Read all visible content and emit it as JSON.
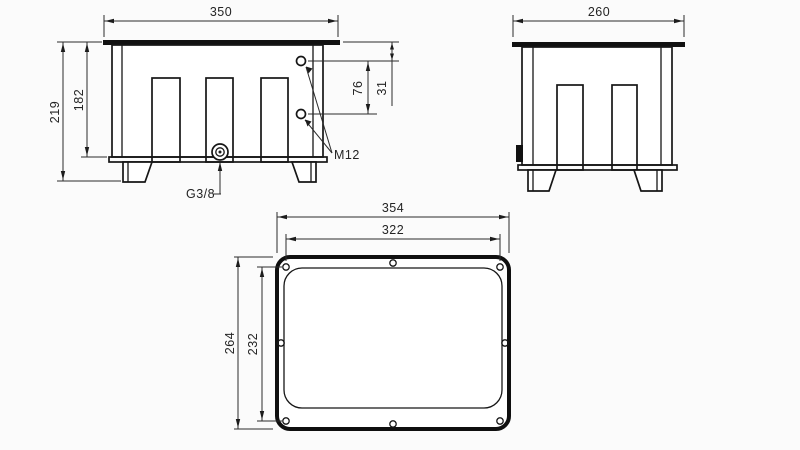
{
  "drawing": {
    "kind": "technical-drawing-tank-3-views",
    "background_color": "#fbfbfb",
    "line_color": "#161616",
    "front_view": {
      "width_dim": "350",
      "overall_height_dim": "219",
      "inner_height_dim": "182",
      "hole_spacing_dim": "76",
      "hole_offset_dim": "31",
      "thread_label": "M12",
      "drain_label": "G3/8"
    },
    "side_view": {
      "width_dim": "260"
    },
    "top_view": {
      "outer_width_dim": "354",
      "bolt_width_dim": "322",
      "outer_height_dim": "264",
      "bolt_height_dim": "232"
    }
  }
}
